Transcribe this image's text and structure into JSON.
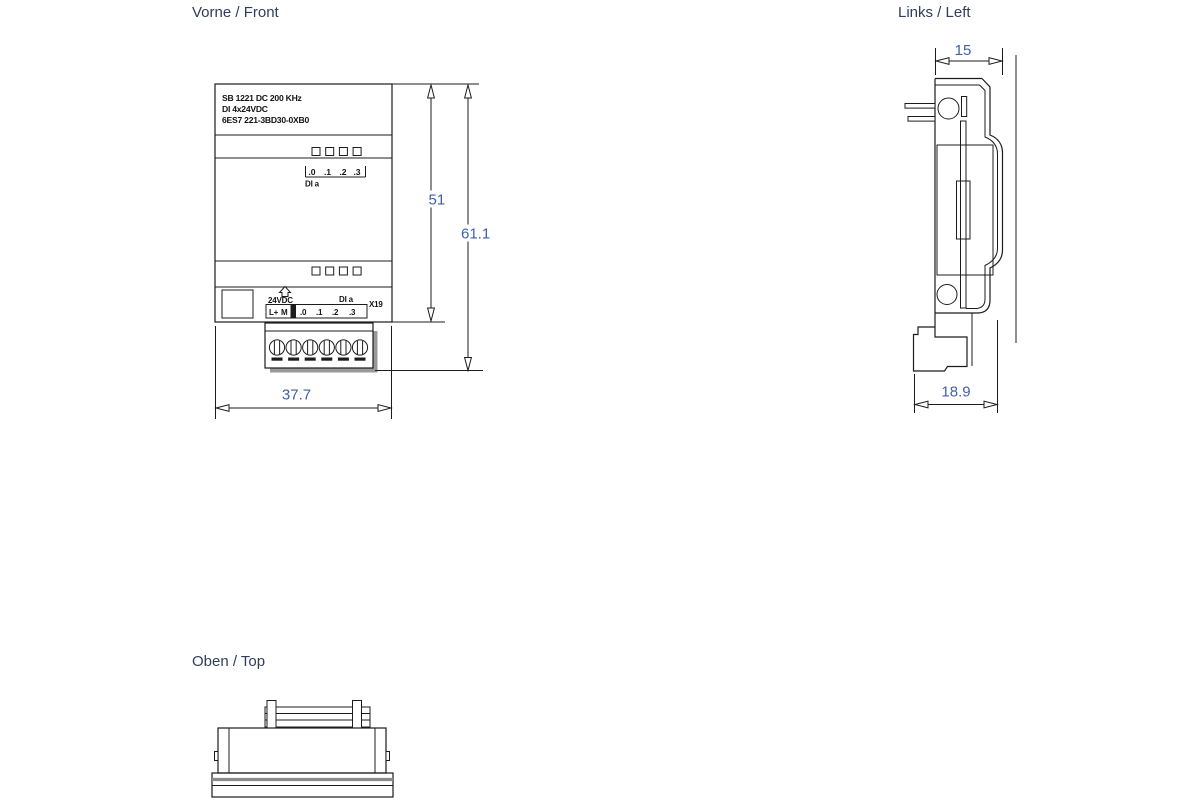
{
  "page": {
    "background": "#ffffff"
  },
  "colors": {
    "line": "#1c1c1c",
    "dimension_text": "#3f5fa8",
    "title_text": "#2e3e5c",
    "shadow": "#999999"
  },
  "views": {
    "front": {
      "title": "Vorne / Front",
      "nameplate": [
        "SB 1221 DC 200 KHz",
        "DI 4x24VDC",
        "6ES7 221-3BD30-0XB0"
      ],
      "channel_labels": [
        ".0",
        ".1",
        ".2",
        ".3"
      ],
      "di_group_label": "DI a",
      "terminal_block": {
        "supply_label": "24VDC",
        "di_label": "DI a",
        "connector_id": "X19",
        "left_terminals": [
          "L+",
          "M"
        ],
        "right_terminals": [
          ".0",
          ".1",
          ".2",
          ".3"
        ]
      },
      "dims": {
        "body_height": "51",
        "total_height": "61.1",
        "width": "37.7"
      }
    },
    "left": {
      "title": "Links / Left",
      "dims": {
        "top_depth": "15",
        "bottom_depth": "18.9"
      }
    },
    "top": {
      "title": "Oben / Top"
    }
  }
}
